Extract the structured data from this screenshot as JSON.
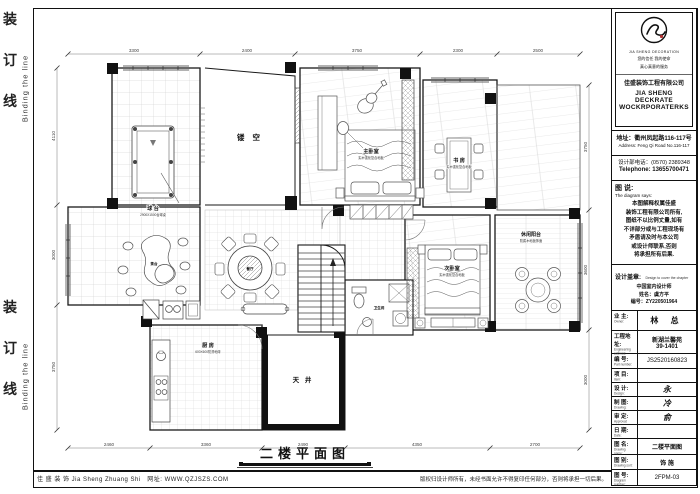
{
  "binding": {
    "chars": [
      "装",
      "订",
      "线"
    ],
    "english": "Binding the line"
  },
  "plan": {
    "title": "二楼平面图",
    "rooms": {
      "void": "镂 空",
      "billiard": {
        "label": "球 台",
        "sub": "2900X1500台球桌"
      },
      "master_bedroom": {
        "label": "主卧室",
        "sub": "实木强化复合地板"
      },
      "study": {
        "label": "书 房",
        "sub": "实木强化复合地板"
      },
      "balcony": {
        "label": "休闲阳台",
        "sub": "防腐木地板饰面"
      },
      "second_bedroom": {
        "label": "次卧室",
        "sub": "实木强化复合地板"
      },
      "kitchen": {
        "label": "厨 房",
        "sub": "600X600防滑地砖"
      },
      "courtyard": "天 井",
      "dining": "餐厅",
      "bath": "卫生间",
      "tea": "茶台"
    },
    "dims": {
      "top": [
        "3300",
        "2400",
        "3750",
        "2300",
        "2500"
      ],
      "left": [
        "4110",
        "3000",
        "3750"
      ],
      "right": [
        "3750",
        "3600",
        "3000"
      ],
      "bottom": [
        "2460",
        "3360",
        "2490",
        "4350",
        "2700"
      ]
    }
  },
  "footer": {
    "left": "佳 盛 装 饰 Jia Sheng Zhuang Shi",
    "site": "网址: WWW.QZJSZS.COM",
    "right": "版权归设计师所有，未经书面允许不得复印任何部分，否则将承担一切后果。"
  },
  "titleblock": {
    "logo": {
      "monogram": "JS",
      "brand_en_small": "JIA SHENG DECORATION",
      "slogan1": "您的信任 我的使命",
      "slogan2": "真心真意的服务",
      "company_cn": "佳盛装饰工程有限公司",
      "company_en1": "JIA SHENG DECKRATE",
      "company_en2": "WOCKRPORATERKS"
    },
    "address_cn": "地址：衢州凤起路116-117号",
    "address_en": "Address: Feng Qi Road No.116-117",
    "phone_cn": "设计部电话：(0570) 2389348",
    "phone_en": "Telephone: 13655700471",
    "says_title": "图 说:",
    "says_en": "The diagram says:",
    "says_lines": [
      "本图解释权属佳盛",
      "装饰工程有限公司所有,",
      "图纸不以比例丈量,如有",
      "不详部分或与工程现场有",
      "矛盾请及时与本公司",
      "或设计师联系,否则",
      "将承担所有后果."
    ],
    "seal_title": "设计盖章:",
    "seal_en": "Design to cover the chapter",
    "seal_lines": [
      "中国室内设计师",
      "姓名：虞方平",
      "编号：ZY220501964"
    ],
    "rows": [
      {
        "cn": "业 主:",
        "en": "Owner:",
        "value": "林 总"
      },
      {
        "cn": "工程地址:",
        "en": "Engineering address:",
        "value": "新湖兰馨苑",
        "value2": "39-1401"
      },
      {
        "cn": "编 号:",
        "en": "Part number:",
        "value": "JS2520160823"
      },
      {
        "cn": "项 目:",
        "en": "Item:",
        "value": ""
      },
      {
        "cn": "设 计:",
        "en": "Design:",
        "value": "永"
      },
      {
        "cn": "制 图:",
        "en": "Drawing:",
        "value": "冷"
      },
      {
        "cn": "审 定:",
        "en": "Approval:",
        "value": "俞"
      },
      {
        "cn": "日 期:",
        "en": "Date:",
        "value": ""
      },
      {
        "cn": "图 名:",
        "en": "Drawing name:",
        "value": "二楼平面图"
      },
      {
        "cn": "图 别:",
        "en": "Drawing sort:",
        "value": "饰 施"
      },
      {
        "cn": "图 号:",
        "en": "Diagram number:",
        "value": "2FPM-03"
      }
    ]
  }
}
